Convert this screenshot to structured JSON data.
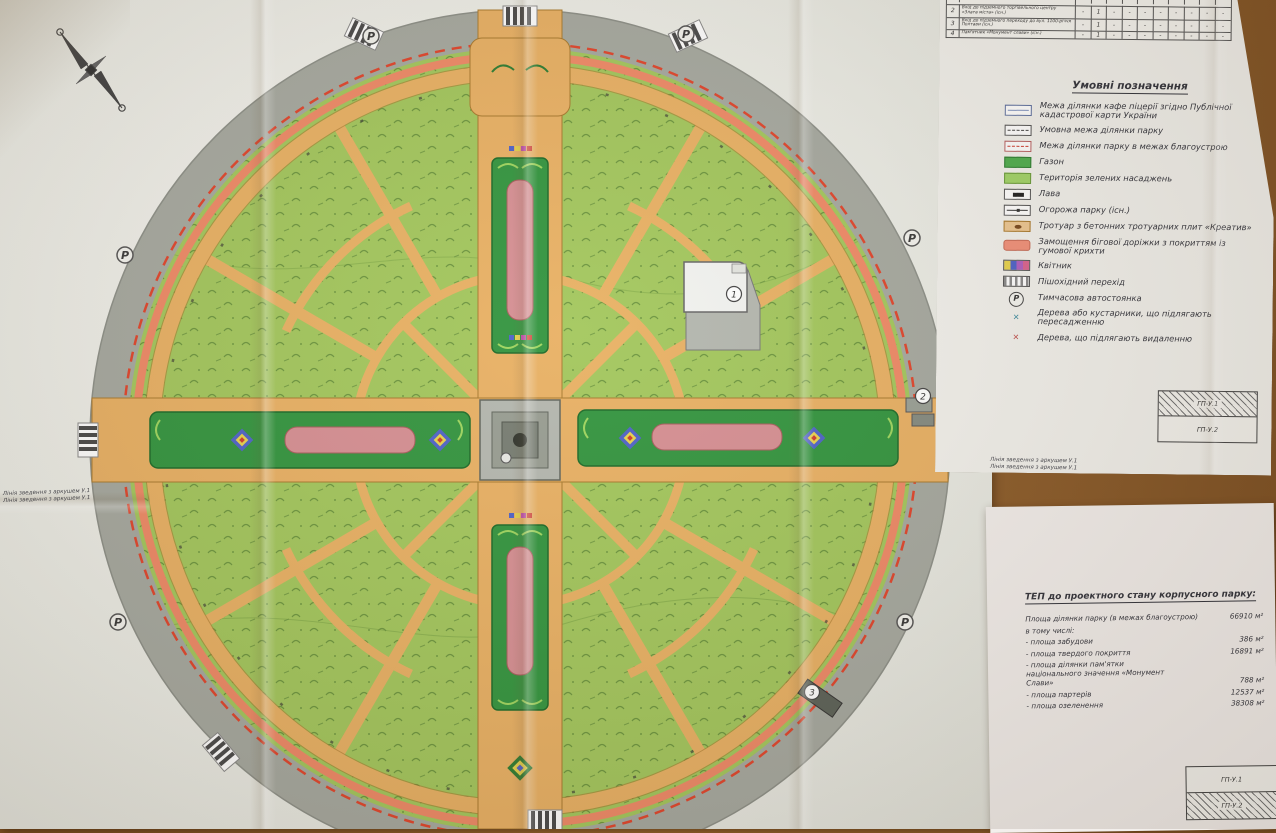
{
  "table": {
    "rows": [
      {
        "no": "2",
        "name": "Вхід до підземного торгівельного центру «Злата міста» (існ.)",
        "values": [
          "-",
          "1",
          "-",
          "-",
          "-",
          "-",
          "-",
          "-",
          "-",
          "-"
        ]
      },
      {
        "no": "3",
        "name": "Вхід до підземного переходу до вул. 1100-річчя Полтави (існ.)",
        "values": [
          "-",
          "1",
          "-",
          "-",
          "-",
          "-",
          "-",
          "-",
          "-",
          "-"
        ]
      },
      {
        "no": "4",
        "name": "Пам'ятник «Монумент слави» (існ.)",
        "values": [
          "-",
          "1",
          "-",
          "-",
          "-",
          "-",
          "-",
          "-",
          "-",
          "-"
        ]
      }
    ]
  },
  "legend": {
    "title": "Умовні позначення",
    "items": [
      "Межа ділянки кафе піцерії згідно Публічної кадастрової карти України",
      "Умовна межа ділянки парку",
      "Межа ділянки парку в межах благоустрою",
      "Газон",
      "Територія зелених насаджень",
      "Лава",
      "Огорожа парку (існ.)",
      "Тротуар з бетонних тротуарних плит «Креатив»",
      "Замощення бігової доріжки з покриттям із гумової крихти",
      "Квітник",
      "Пішохідний перехід",
      "Тимчасова автостоянка",
      "Дерева або кустарники, що підлягають пересадженню",
      "Дерева, що підлягають видаленню"
    ]
  },
  "tep": {
    "title": "ТЕП до проектного стану корпусного парку:",
    "rows": [
      {
        "label": "Площа ділянки парку (в межах благоустрою)",
        "value": "66910 м²"
      },
      {
        "label": "в тому числі:",
        "value": ""
      },
      {
        "label": "- площа забудови",
        "value": "386 м²"
      },
      {
        "label": "- площа твердого покриття",
        "value": "16891 м²"
      },
      {
        "label": "- площа ділянки пам'ятки національного значення «Монумент Слави»",
        "value": "788 м²"
      },
      {
        "label": "- площа партерів",
        "value": "12537 м²"
      },
      {
        "label": "- площа озеленення",
        "value": "38308 м²"
      }
    ]
  },
  "sheet_keys": {
    "top": {
      "rows": [
        {
          "label": "ГП-У.1",
          "hatched": true
        },
        {
          "label": "ГП-У.2",
          "hatched": false
        }
      ]
    },
    "bottom": {
      "rows": [
        {
          "label": "ГП-У.1",
          "hatched": false
        },
        {
          "label": "ГП-У.2",
          "hatched": true
        }
      ]
    }
  },
  "edge_notes": {
    "left": [
      "Лінія зведення з аркушем У.1",
      "Лінія зведення з аркушем У.1"
    ],
    "right": [
      "Лінія зведення з аркушем У.1",
      "Лінія зведення з аркушем У.1"
    ]
  },
  "map": {
    "markers": {
      "cafe": "1",
      "mall_entrance": "2",
      "underpass": "3",
      "parking_letter": "Р"
    }
  },
  "colors": {
    "lawn": "#4fae4e",
    "greenery": "#a3c75d",
    "walkway_tan": "#e9b164",
    "track_coral": "#ef8a67",
    "flowerbed_pink": "#d68f93",
    "boundary_red": "#e0452c",
    "plaza_gray": "#b4b7af",
    "outer_ring_gray": "#a6a9a0",
    "desk_brown": "#8a5a28"
  }
}
